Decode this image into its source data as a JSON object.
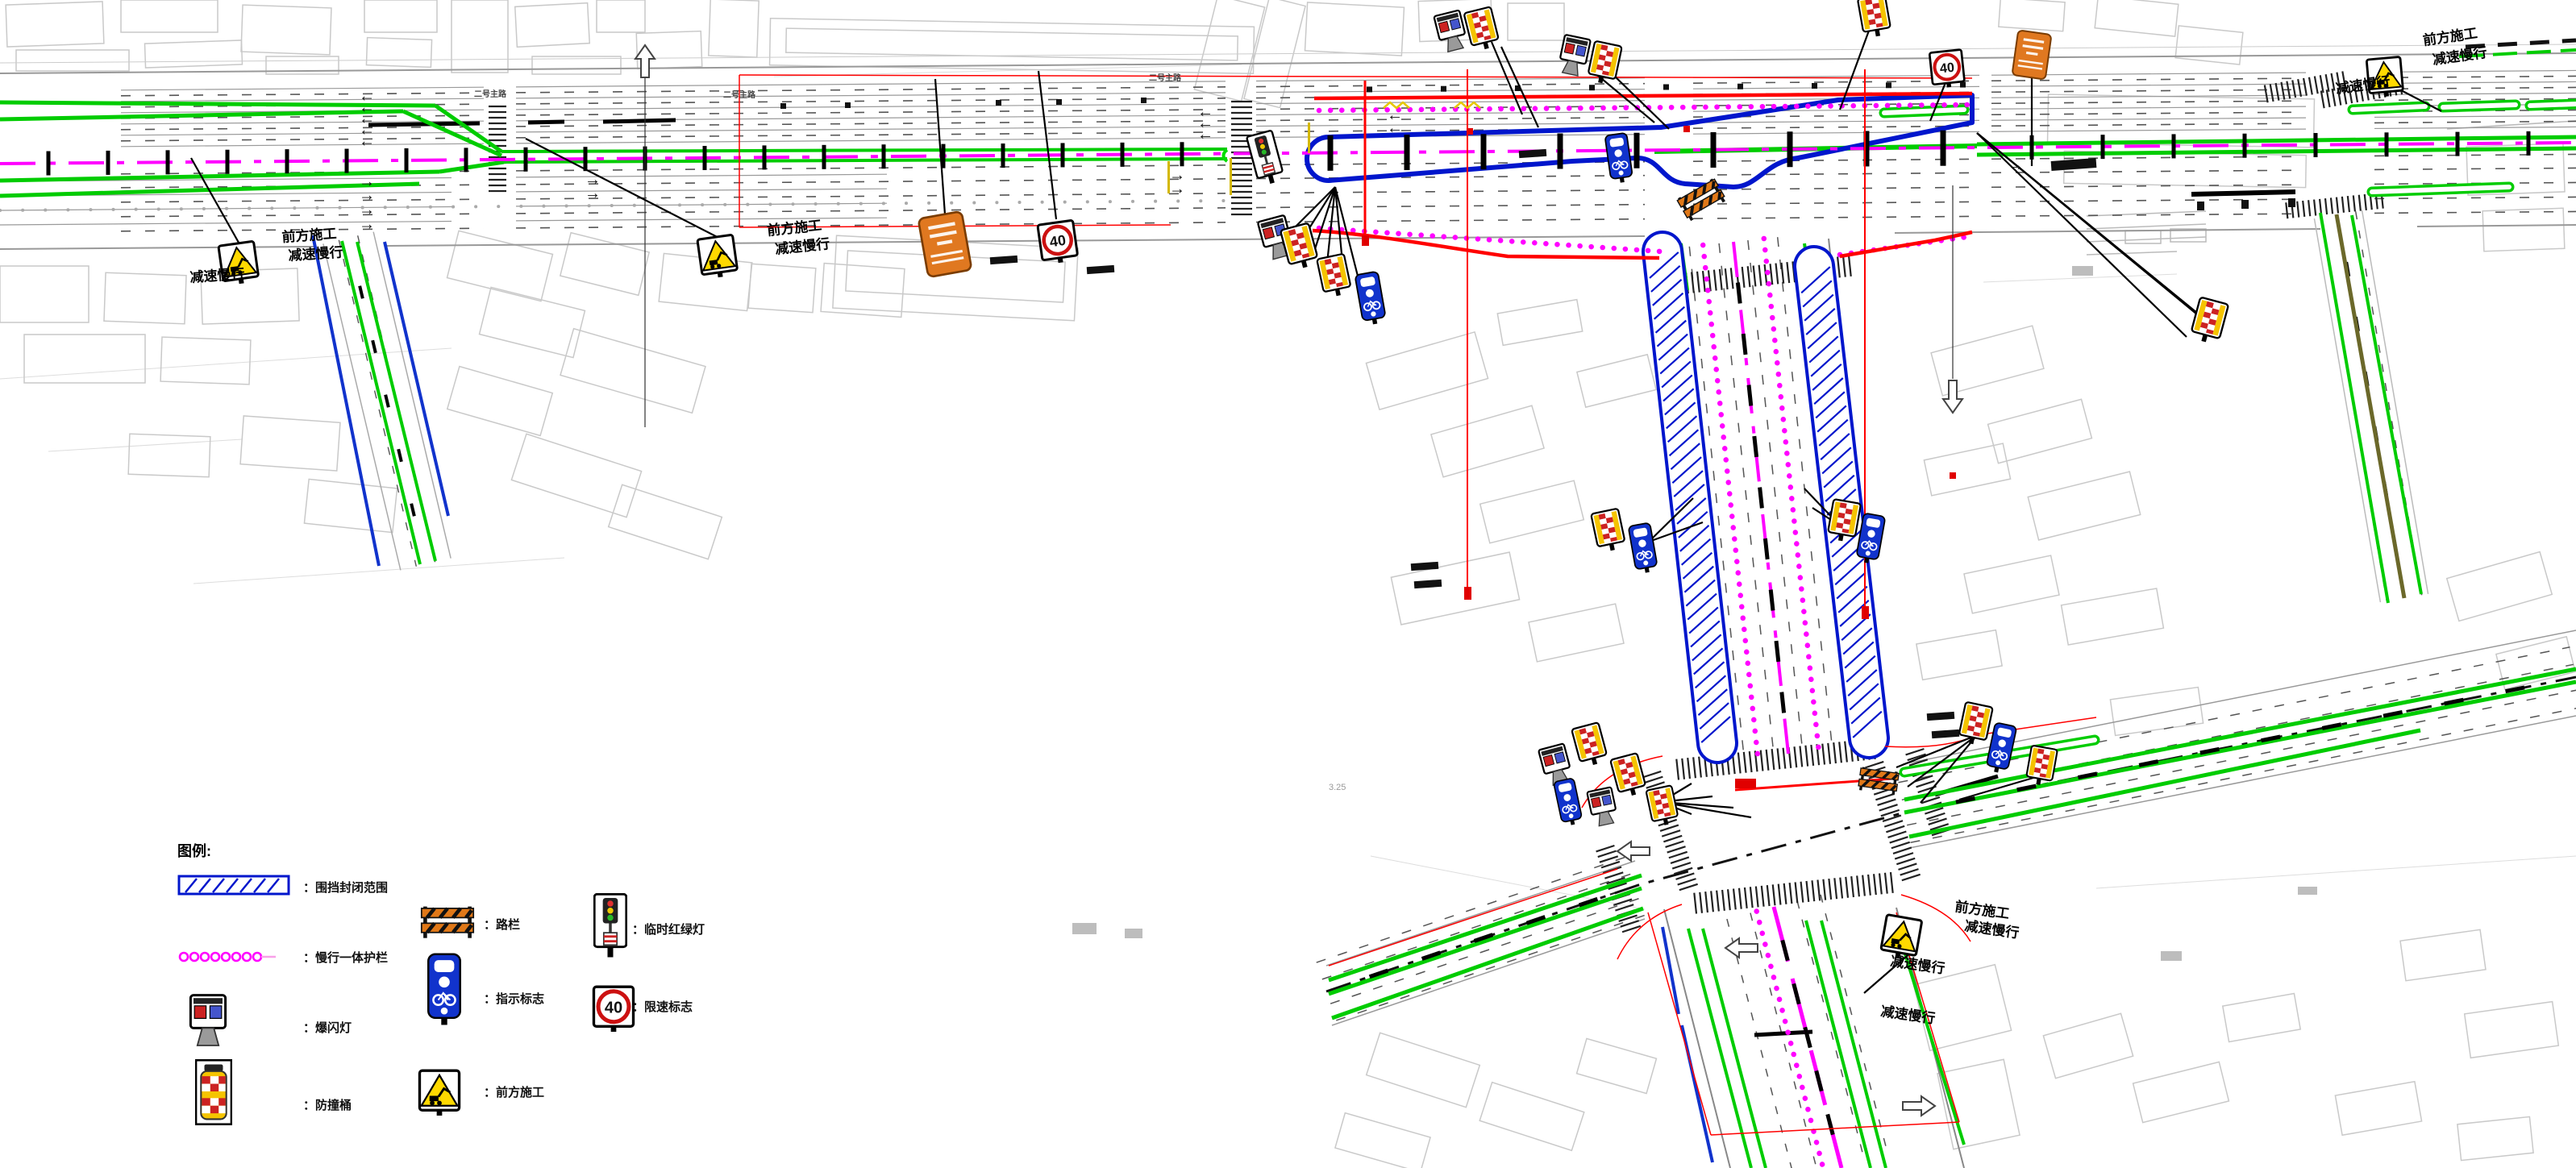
{
  "drawing": {
    "legend": {
      "title": "图例:",
      "items": [
        {
          "id": "enclosure",
          "label": "：围挡封闭范围"
        },
        {
          "id": "slow-barrier",
          "label": "：慢行一体护栏"
        },
        {
          "id": "strobe-light",
          "label": "：爆闪灯"
        },
        {
          "id": "crash-barrel",
          "label": "：防撞桶"
        },
        {
          "id": "road-barrier",
          "label": "：路栏"
        },
        {
          "id": "guide-sign",
          "label": "：指示标志"
        },
        {
          "id": "construction-ahead",
          "label": "：前方施工"
        },
        {
          "id": "temp-signal",
          "label": "：临时红绿灯"
        },
        {
          "id": "speed-limit",
          "label": "：限速标志"
        }
      ]
    },
    "callouts": {
      "construction": "前方施工",
      "slow_down": "减速慢行"
    },
    "signs": {
      "speed_limit_value": "40"
    },
    "road_labels": {
      "main_road": "二号主路"
    },
    "annotations": {
      "dimension_note": "3.25"
    },
    "colors": {
      "enclosure_blue": "#0016cc",
      "barrier_magenta": "#ff00ff",
      "lane_green": "#00cc00",
      "boundary_red": "#ff0000",
      "warning_yellow": "#ffd900",
      "board_orange": "#e07820"
    }
  }
}
